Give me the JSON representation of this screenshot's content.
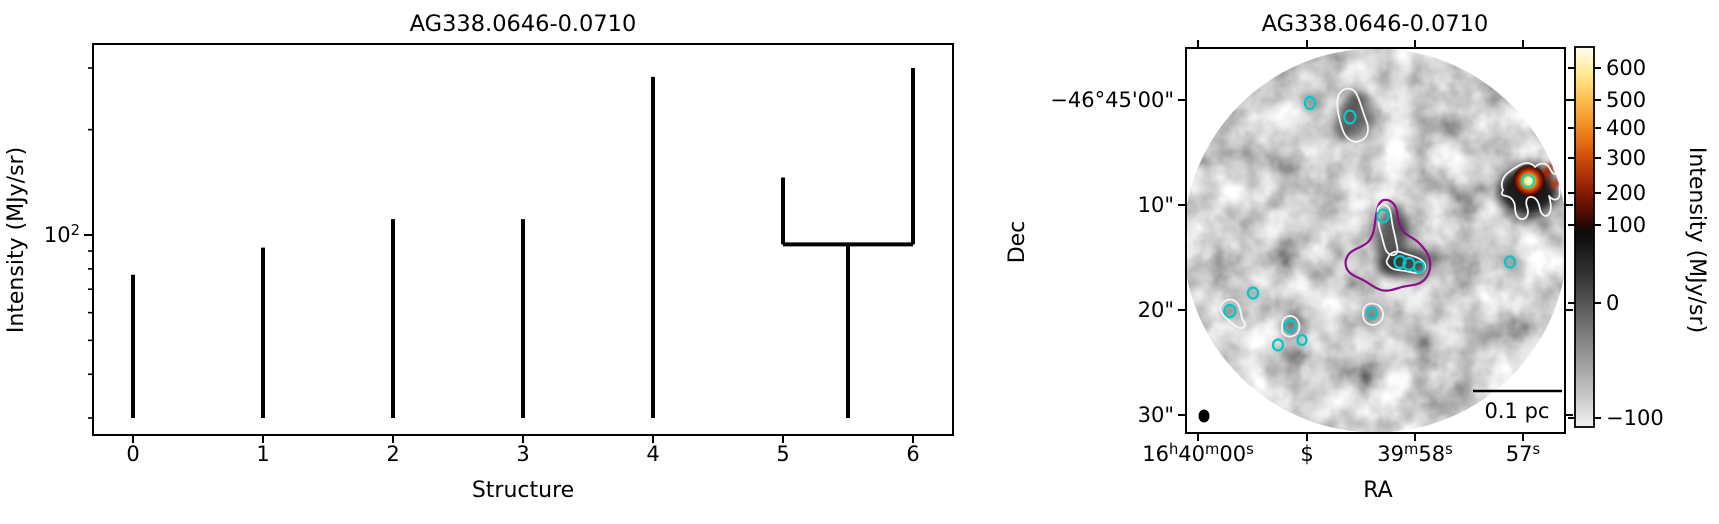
{
  "figure": {
    "background": "#ffffff",
    "text_color": "#000000"
  },
  "left_panel": {
    "title": "AG338.0646-0.0710",
    "xlabel": "Structure",
    "ylabel": "Intensity (MJy/sr)"
  },
  "right_panel": {
    "title": "AG338.0646-0.0710",
    "xlabel": "RA",
    "ylabel": "Dec",
    "colorbar_label": "Intensity (MJy/sr)",
    "scalebar_label": "0.1 pc"
  },
  "chart_data": [
    {
      "type": "dendrogram",
      "title": "AG338.0646-0.0710",
      "xlabel": "Structure",
      "ylabel": "Intensity (MJy/sr)",
      "yscale": "log",
      "xlim": [
        -0.31,
        6.31
      ],
      "ylim": [
        27,
        350
      ],
      "x_ticks": [
        "0",
        "1",
        "2",
        "3",
        "4",
        "5",
        "6"
      ],
      "y_major_ticks": [
        {
          "value": 100,
          "label": "10^2"
        }
      ],
      "y_minor_ticks": [
        30,
        40,
        50,
        60,
        70,
        80,
        90,
        200,
        300
      ],
      "line_color": "#000000",
      "leaves": [
        {
          "structure": 0,
          "x": 0,
          "base": 30,
          "peak": 77
        },
        {
          "structure": 1,
          "x": 1,
          "base": 30,
          "peak": 92
        },
        {
          "structure": 2,
          "x": 2,
          "base": 30,
          "peak": 111
        },
        {
          "structure": 3,
          "x": 3,
          "base": 30,
          "peak": 111
        },
        {
          "structure": 4,
          "x": 4,
          "base": 30,
          "peak": 283
        },
        {
          "structure": 5,
          "x": 5,
          "base": 94,
          "peak": 146
        },
        {
          "structure": 6,
          "x": 6,
          "base": 94,
          "peak": 300
        }
      ],
      "merges": [
        {
          "x_left": 5,
          "x_right": 6,
          "level": 94,
          "trunk_x": 5.5,
          "trunk_base": 30
        }
      ]
    },
    {
      "type": "map",
      "title": "AG338.0646-0.0710",
      "xlabel": "RA",
      "ylabel": "Dec",
      "x_tick_labels": [
        "16^h40^m00^s",
        "$",
        "39^m58^s",
        "57^s"
      ],
      "y_tick_labels": [
        "−46°45'00\"",
        "10\"",
        "20\"",
        "30\""
      ],
      "scalebar": {
        "label": "0.1 pc"
      },
      "beam": {
        "x": 1204,
        "y": 416,
        "rx": 5.5,
        "ry": 6.5
      },
      "colorbar": {
        "label": "Intensity (MJy/sr)",
        "ticks": [
          {
            "label": "600",
            "y": 68
          },
          {
            "label": "500",
            "y": 100
          },
          {
            "label": "400",
            "y": 128
          },
          {
            "label": "300",
            "y": 158
          },
          {
            "label": "200",
            "y": 193
          },
          {
            "label": "100",
            "y": 225
          },
          {
            "label": "0",
            "y": 303
          },
          {
            "label": "−100",
            "y": 418
          }
        ],
        "gradient": [
          [
            0.0,
            "#fffdf0"
          ],
          [
            0.02,
            "#fff9d8"
          ],
          [
            0.06,
            "#ffeea0"
          ],
          [
            0.1,
            "#ffd976"
          ],
          [
            0.14,
            "#fdbe4e"
          ],
          [
            0.19,
            "#f49a2c"
          ],
          [
            0.24,
            "#e77414"
          ],
          [
            0.29,
            "#cf4f0a"
          ],
          [
            0.34,
            "#ad3005"
          ],
          [
            0.39,
            "#801803"
          ],
          [
            0.44,
            "#4c0d02"
          ],
          [
            0.475,
            "#1c0a04"
          ],
          [
            0.5,
            "#0e0e0e"
          ],
          [
            0.56,
            "#262626"
          ],
          [
            0.62,
            "#3c3c3c"
          ],
          [
            0.673,
            "#555555"
          ],
          [
            0.75,
            "#7a7a7a"
          ],
          [
            0.84,
            "#a3a3a3"
          ],
          [
            0.93,
            "#cdcdcd"
          ],
          [
            0.976,
            "#e6e6e6"
          ],
          [
            1.0,
            "#f0f0f0"
          ]
        ]
      },
      "marker_color": "#00c9c9",
      "contour_colors": {
        "white": "#f5f5f5",
        "purple": "#8e0d8c"
      },
      "sources": [
        [
          1310,
          103,
          5,
          6
        ],
        [
          1350,
          117,
          5.5,
          6.5
        ],
        [
          1383,
          216,
          5.5,
          6.5
        ],
        [
          1400,
          262,
          5.5,
          6
        ],
        [
          1409,
          264,
          5.5,
          6
        ],
        [
          1419,
          267,
          5,
          5.5
        ],
        [
          1510,
          262,
          5,
          5.5
        ],
        [
          1253,
          293,
          5,
          5.5
        ],
        [
          1230,
          311,
          5.5,
          6
        ],
        [
          1290,
          326,
          5.5,
          6
        ],
        [
          1278,
          345,
          5,
          5.5
        ],
        [
          1302,
          340,
          4.5,
          5
        ],
        [
          1372,
          313,
          5,
          5.5
        ]
      ],
      "bright_source": {
        "x": 1528,
        "y": 181,
        "r": 17
      },
      "contours_white": [
        "M1340,93 C1344,87 1352,87 1356,93 C1360,100 1362,110 1366,120 C1370,130 1368,138 1360,141 C1352,144 1345,138 1342,128 C1339,118 1334,100 1340,93 Z",
        "M1503,190 C1500,184 1503,176 1509,172 C1513,169 1517,166 1522,164 C1527,162 1532,163 1535,167 C1538,164 1543,162 1547,165 C1551,168 1551,174 1555,174 C1559,174 1562,179 1560,184 C1558,188 1561,192 1559,197 C1557,201 1552,200 1549,196 C1551,203 1552,210 1549,214 C1546,218 1541,215 1540,209 C1539,203 1537,198 1532,197 C1527,196 1525,201 1527,207 C1529,212 1528,218 1523,219 C1518,220 1515,214 1515,208 C1515,202 1512,197 1506,196 C1501,195 1501,194 1503,190 Z",
        "M1378,214 C1376,207 1382,202 1387,206 C1391,209 1391,216 1392,222 C1393,229 1395,235 1396,241 C1397,247 1399,251 1396,254 C1392,257 1387,254 1385,248 C1383,242 1382,236 1380,230 C1378,224 1379,220 1378,214 Z",
        "M1388,258 C1390,252 1397,250 1403,253 C1408,255 1415,256 1420,259 C1425,262 1427,267 1423,271 C1419,275 1411,272 1405,271 C1399,270 1392,270 1389,266 C1386,263 1386,261 1388,258 Z",
        "M1222,304 C1226,298 1234,298 1238,304 C1242,310 1240,318 1244,322 C1248,326 1242,330 1237,327 C1232,324 1228,320 1224,316 C1220,312 1219,308 1222,304 Z",
        "M1283,320 C1287,314 1295,315 1298,321 C1301,327 1299,334 1293,336 C1287,338 1281,334 1282,328 C1282,324 1282,322 1283,320 Z",
        "M1364,308 C1367,302 1377,302 1381,308 C1385,314 1383,321 1377,324 C1371,327 1364,323 1363,316 C1363,312 1363,310 1364,308 Z"
      ],
      "contours_purple": [
        "M1384,200 C1391,199 1396,205 1397,212 C1398,219 1399,226 1403,231 C1407,236 1414,238 1419,243 C1424,248 1429,254 1430,261 C1431,268 1429,276 1423,281 C1417,286 1409,285 1402,287 C1395,289 1388,292 1381,290 C1374,288 1369,283 1363,280 C1357,277 1350,275 1347,269 C1344,263 1346,256 1351,252 C1356,248 1363,247 1368,242 C1373,237 1374,230 1375,223 C1376,216 1377,201 1384,200 Z"
      ]
    }
  ]
}
